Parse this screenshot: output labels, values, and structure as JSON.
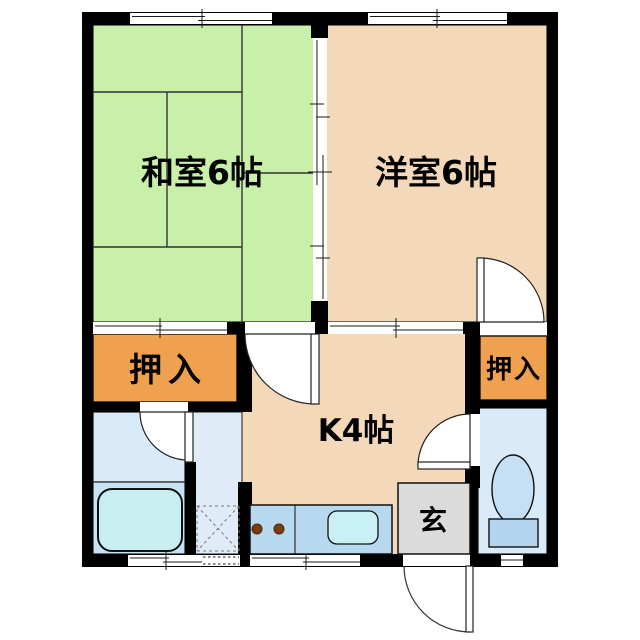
{
  "floorplan": {
    "type": "japanese-apartment-floor-plan",
    "rooms": {
      "washitsu": {
        "label": "和室6帖",
        "kind": "japanese-tatami-room",
        "size_mats": 6
      },
      "yoshitsu": {
        "label": "洋室6帖",
        "kind": "western-room",
        "size_mats": 6
      },
      "kitchen": {
        "label": "K4帖",
        "kind": "kitchen",
        "size_mats": 4
      },
      "closet_left": {
        "label": "押入",
        "kind": "closet"
      },
      "closet_right": {
        "label": "押入",
        "kind": "closet"
      },
      "genkan": {
        "label": "玄",
        "kind": "entrance"
      }
    },
    "fixtures": [
      "bathtub",
      "washing-machine-pan",
      "kitchen-counter",
      "stove-burners",
      "kitchen-sink",
      "toilet"
    ],
    "colors": {
      "wall_black": "#000000",
      "tatami_green": "#C8F0A8",
      "wood_peach": "#F3D8BA",
      "closet_orange": "#F0A14F",
      "wet_blue": "#D9EAF8",
      "bath_blue": "#C7E2F4",
      "corridor_blue": "#DFECF8",
      "tub_cyan": "#C9EEF2",
      "counter_blue": "#B7D8EE",
      "sink_cyan": "#C9F0F5",
      "genkan_gray": "#DBDBDB",
      "toilet_bowl": "#C5E0F5",
      "toilet_tank": "#B3D4EC",
      "burner_brown": "#7A3D12",
      "paper_white": "#FFFFFF"
    }
  }
}
